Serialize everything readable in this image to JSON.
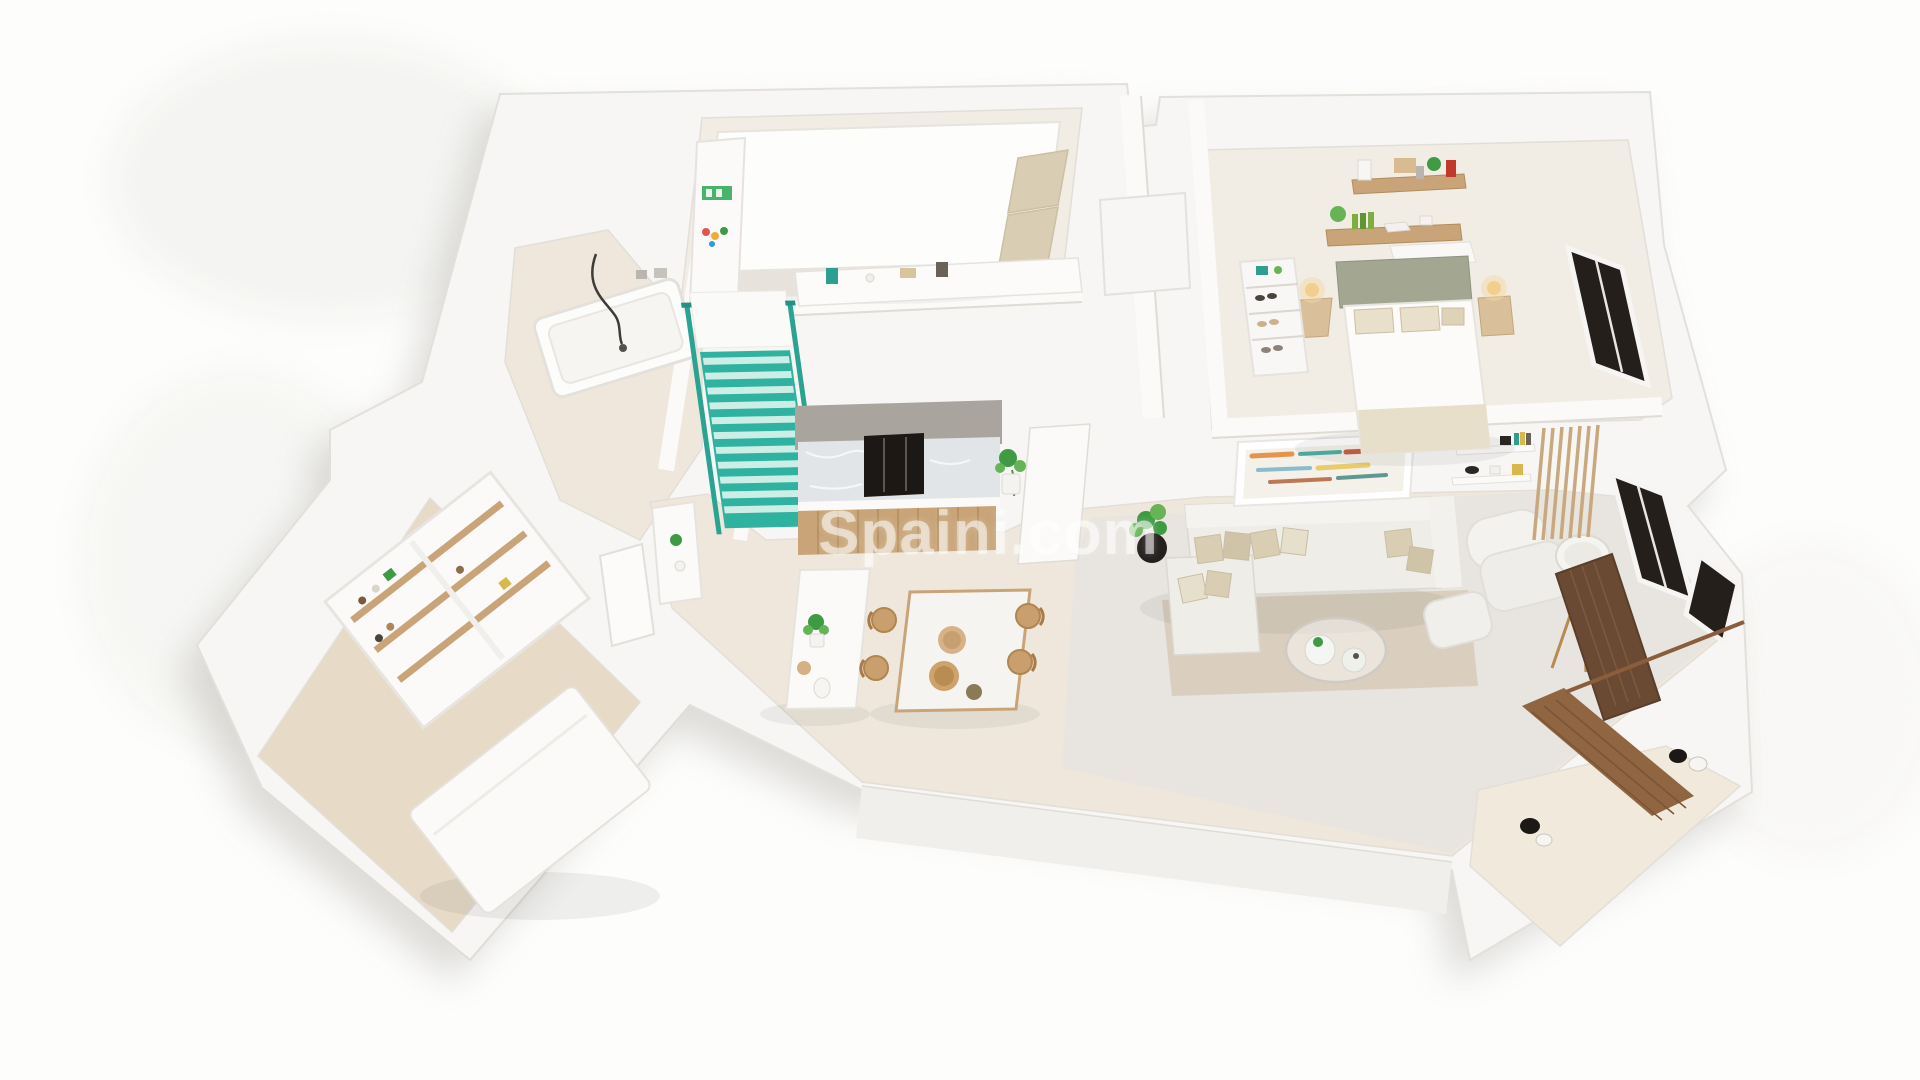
{
  "page": {
    "title": "3D isometric apartment floor plan render"
  },
  "watermark": {
    "text": "Spaini.com"
  },
  "colors": {
    "background": "#fdfdfc",
    "slab": "#f7f6f4",
    "wall_face": "#f1efeb",
    "floor_beige": "#efe7db",
    "floor_concrete": "#e8e4df",
    "floor_tile": "#f2e9dd",
    "bedroom_floor": "#f1ece4",
    "carpet": "#e7dbc8",
    "rug": "#d8cdbb",
    "stairs_teal": "#2fb3a0",
    "stairs_step_light": "#cdeee7",
    "wood": "#c8a478",
    "wood_dark": "#8f6542",
    "wood_darker": "#6b4a33",
    "marble": "#e2e5e8",
    "appliance_dark": "#1c1815",
    "window_dark": "#241f1b",
    "plant": "#3e9b43",
    "plant_light": "#67b457",
    "sofa": "#efede7",
    "cushion": "#d9cdb4",
    "headboard": "#a3a691",
    "lamp_glow": "#f6d9a2",
    "accent_red": "#c0392b",
    "watermark": "rgba(255,255,255,0.55)"
  },
  "scene": {
    "style": "3d-isometric-floor-plan-render",
    "rooms": [
      {
        "name": "bathroom",
        "furniture": [
          "bathtub",
          "hand-shower-hose"
        ]
      },
      {
        "name": "bedroom-top",
        "furniture": [
          "double-bed",
          "beige-pillows",
          "white-closet",
          "shelf-unit",
          "wall-console"
        ]
      },
      {
        "name": "staircase",
        "detail": "teal-painted-steps-and-railing"
      },
      {
        "name": "kitchen",
        "furniture": [
          "marble-backsplash",
          "dark-built-in-appliance",
          "wood-base-cabinets",
          "island-counter",
          "plant",
          "vase"
        ]
      },
      {
        "name": "dining-area",
        "furniture": [
          "marble-table",
          "wooden-chairs",
          "rattan-bowls"
        ]
      },
      {
        "name": "living-room",
        "furniture": [
          "l-shaped-sofa",
          "throw-pillows",
          "rug",
          "glass-coffee-table",
          "armchair",
          "ottoman",
          "tripod-floor-lamp",
          "plant-in-black-pot",
          "abstract-wall-art",
          "floating-shelves",
          "wood-slat-panel"
        ]
      },
      {
        "name": "bedroom-right",
        "furniture": [
          "double-bed",
          "sage-headboard",
          "bedside-tables",
          "glowing-lamps",
          "wood-wall-shelves",
          "closet-shelves-with-shoes"
        ]
      },
      {
        "name": "bedroom-lower-left",
        "furniture": [
          "bed-mattress",
          "open-wardrobe-shelves",
          "door"
        ]
      },
      {
        "name": "terrace",
        "furniture": [
          "wood-deck",
          "privacy-screen",
          "spotlights",
          "railing"
        ]
      }
    ],
    "windows": 3
  }
}
